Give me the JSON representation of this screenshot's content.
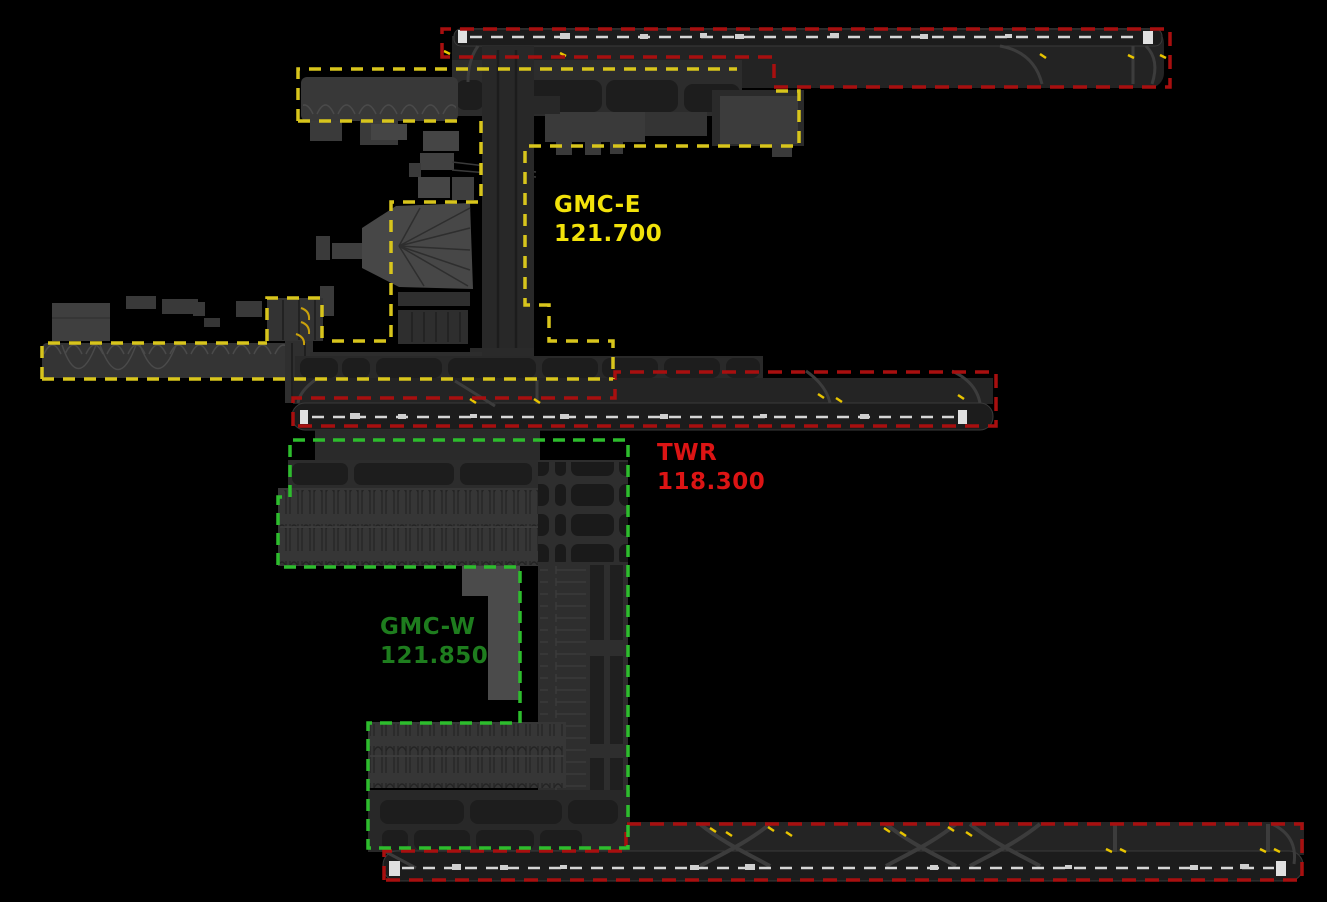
{
  "sectors": [
    {
      "id": "gmc-e",
      "name": "GMC-E",
      "frequency": "121.700",
      "text_color": "#f2e20a",
      "boundary_color": "#d8c51c",
      "boundary_style": "dashed"
    },
    {
      "id": "twr",
      "name": "TWR",
      "frequency": "118.300",
      "text_color": "#dc1414",
      "boundary_color": "#a80f0f",
      "boundary_style": "dashed"
    },
    {
      "id": "gmc-w",
      "name": "GMC-W",
      "frequency": "121.850",
      "text_color": "#1e7d1e",
      "boundary_color": "#2dbd2d",
      "boundary_style": "dashed"
    }
  ],
  "colors": {
    "background": "#000000",
    "gmce_text": "#f2e20a",
    "gmce_dash": "#d8c51c",
    "twr_text": "#dc1414",
    "twr_dash": "#a80f0f",
    "gmcw_text": "#1e7d1e",
    "gmcw_dash": "#2dbd2d",
    "runway_centerline": "#d6d6d6",
    "threshold_white": "#e0e0e0",
    "stopbar_yellow": "#e8c400",
    "stand_guideline_yellow": "#c9a10b"
  }
}
